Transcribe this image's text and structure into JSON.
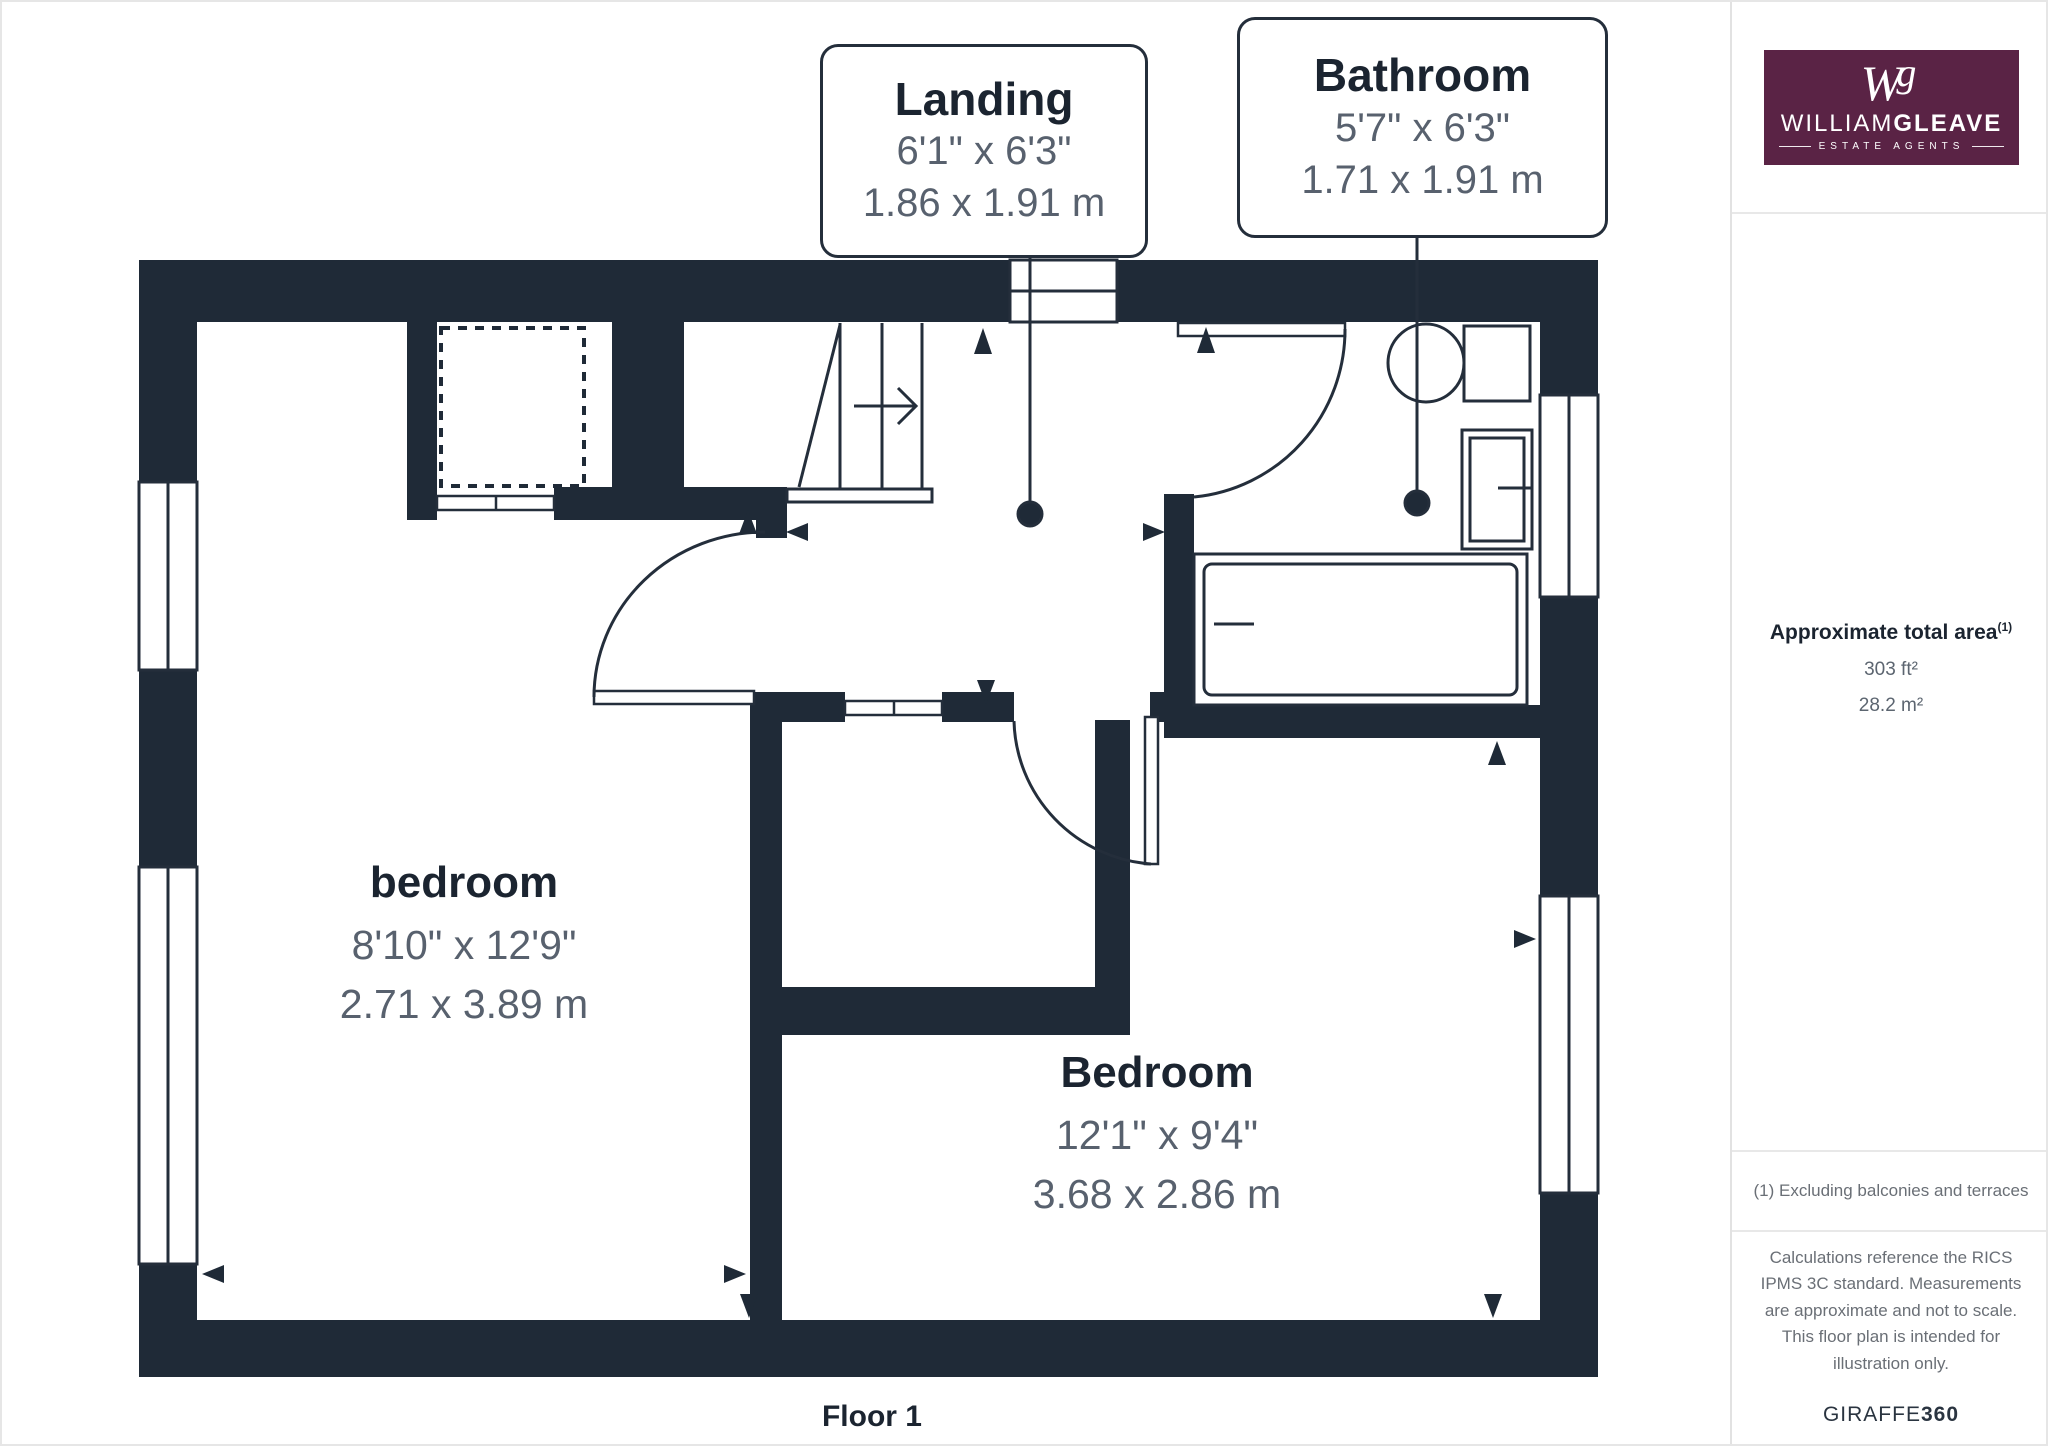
{
  "page": {
    "floor_label": "Floor 1"
  },
  "callouts": [
    {
      "title": "Landing",
      "size_imperial": "6'1\" x 6'3\"",
      "size_metric": "1.86 x 1.91 m"
    },
    {
      "title": "Bathroom",
      "size_imperial": "5'7\" x 6'3\"",
      "size_metric": "1.71 x 1.91 m"
    }
  ],
  "rooms": [
    {
      "name": "bedroom",
      "size_imperial": "8'10\" x 12'9\"",
      "size_metric": "2.71 x 3.89 m"
    },
    {
      "name": "Bedroom",
      "size_imperial": "12'1\" x 9'4\"",
      "size_metric": "3.68 x 2.86 m"
    }
  ],
  "sidebar": {
    "logo": {
      "monogram_w": "W",
      "monogram_g": "g",
      "brand_light": "WILLIAM",
      "brand_bold": "GLEAVE",
      "tagline": "ESTATE AGENTS"
    },
    "area": {
      "heading": "Approximate total area",
      "superscript": "(1)",
      "imperial": "303 ft²",
      "metric": "28.2 m²"
    },
    "footnote": "(1) Excluding balconies and terraces",
    "disclaimer": "Calculations reference the RICS IPMS 3C standard. Measurements are approximate and not to scale. This floor plan is intended for illustration only.",
    "brand_footer_regular": "GIRAFFE",
    "brand_footer_bold": "360"
  },
  "colors": {
    "wall": "#1f2a37",
    "line": "#242e3b",
    "text_dark": "#1b2430",
    "text_gray": "#58616e",
    "brand_purple": "#5a2345"
  }
}
